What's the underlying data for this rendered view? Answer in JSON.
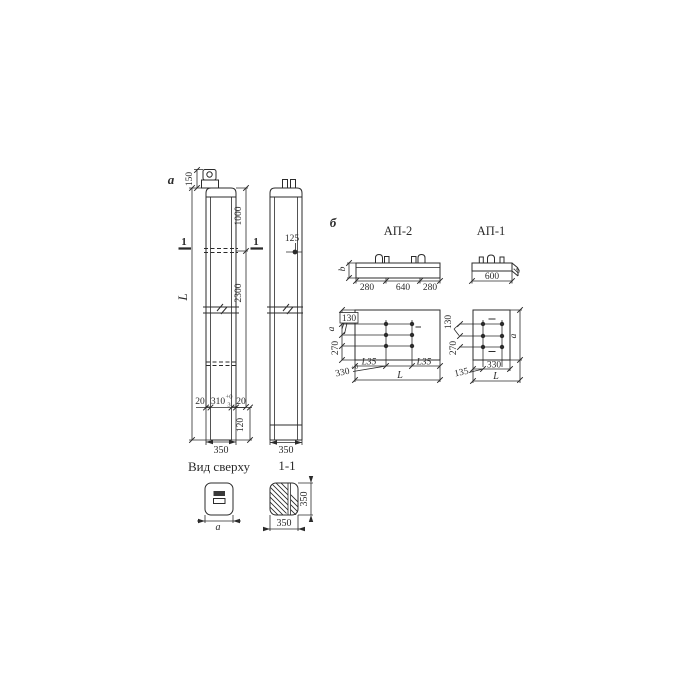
{
  "meta": {
    "background": "#ffffff",
    "ink": "#2b2b2b",
    "drawing_type": "reinforced concrete pole / anchor plate working drawing"
  },
  "front_view": {
    "marker": "a",
    "dims": {
      "d150": "150",
      "d1000": "1000",
      "d2300": "2300",
      "dL": "L",
      "d20l": "20",
      "d310": "310",
      "d310_sup": "+0",
      "d310_sub": "3",
      "d20r": "20",
      "d120": "120",
      "d350": "350"
    },
    "section_marks": {
      "left": "1",
      "right": "1"
    }
  },
  "side_view": {
    "dims": {
      "d125": "125",
      "d350": "350"
    }
  },
  "top_view": {
    "title": "Вид сверху",
    "dims": {
      "da": "a"
    }
  },
  "section_view": {
    "title": "1-1",
    "dims": {
      "d350b": "350",
      "d350r": "350"
    }
  },
  "plates": {
    "marker": "б",
    "ap2": {
      "title": "АП-2",
      "elevation": {
        "db": "b",
        "d280l": "280",
        "d640": "640",
        "d280r": "280"
      },
      "plan": {
        "d130": "130",
        "da": "a",
        "d270": "270",
        "d330": "330",
        "d330_sup": "+0",
        "angle_left": "L35",
        "angle_right": "L35",
        "dL": "L"
      }
    },
    "ap1": {
      "title": "АП-1",
      "elevation": {
        "d600": "600",
        "db": "b"
      },
      "plan": {
        "d130": "130",
        "d270": "270",
        "d135": "135",
        "d330": "330",
        "dL": "L",
        "da": "a"
      }
    }
  }
}
